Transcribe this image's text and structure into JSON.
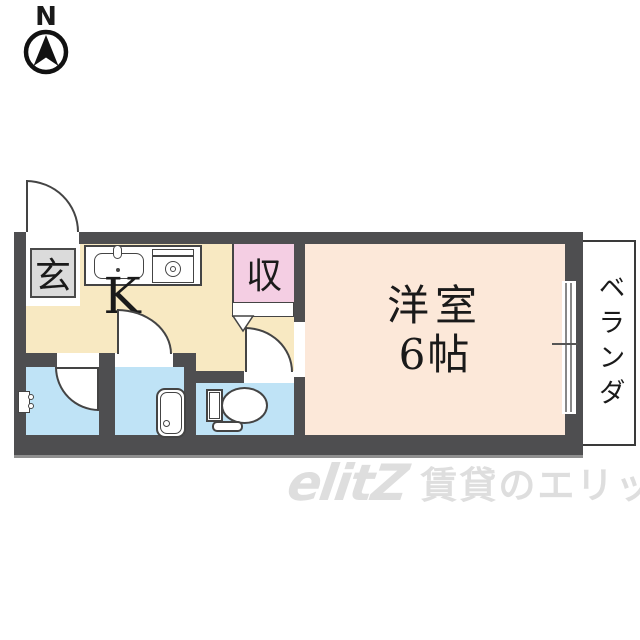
{
  "compass": {
    "north_label": "N"
  },
  "floorplan": {
    "entrance": {
      "label": "玄"
    },
    "kitchen": {
      "label": "K"
    },
    "closet": {
      "label": "収"
    },
    "western_room": {
      "name": "洋室",
      "size": "6帖"
    },
    "veranda": {
      "label": "ベランダ"
    }
  },
  "fixtures": {
    "icons": [
      "north-arrow-icon",
      "sink-icon",
      "stove-icon",
      "folding-door-icon",
      "door-arc-icon",
      "washer-tap-icon",
      "bathtub-icon",
      "toilet-icon",
      "sliding-window-icon"
    ]
  },
  "watermark": {
    "logo": "elitZ",
    "company": "賃貸のエリッツ"
  },
  "colors": {
    "wall": "#4E4E50",
    "kitchen-floor": "#F8E9C2",
    "room-floor": "#FCE8D9",
    "closet-fill": "#F4CEE3",
    "wet": "#BFE3F6",
    "tile": "#DBDBDB",
    "line": "#444444",
    "wm": "#DEDEDE"
  }
}
